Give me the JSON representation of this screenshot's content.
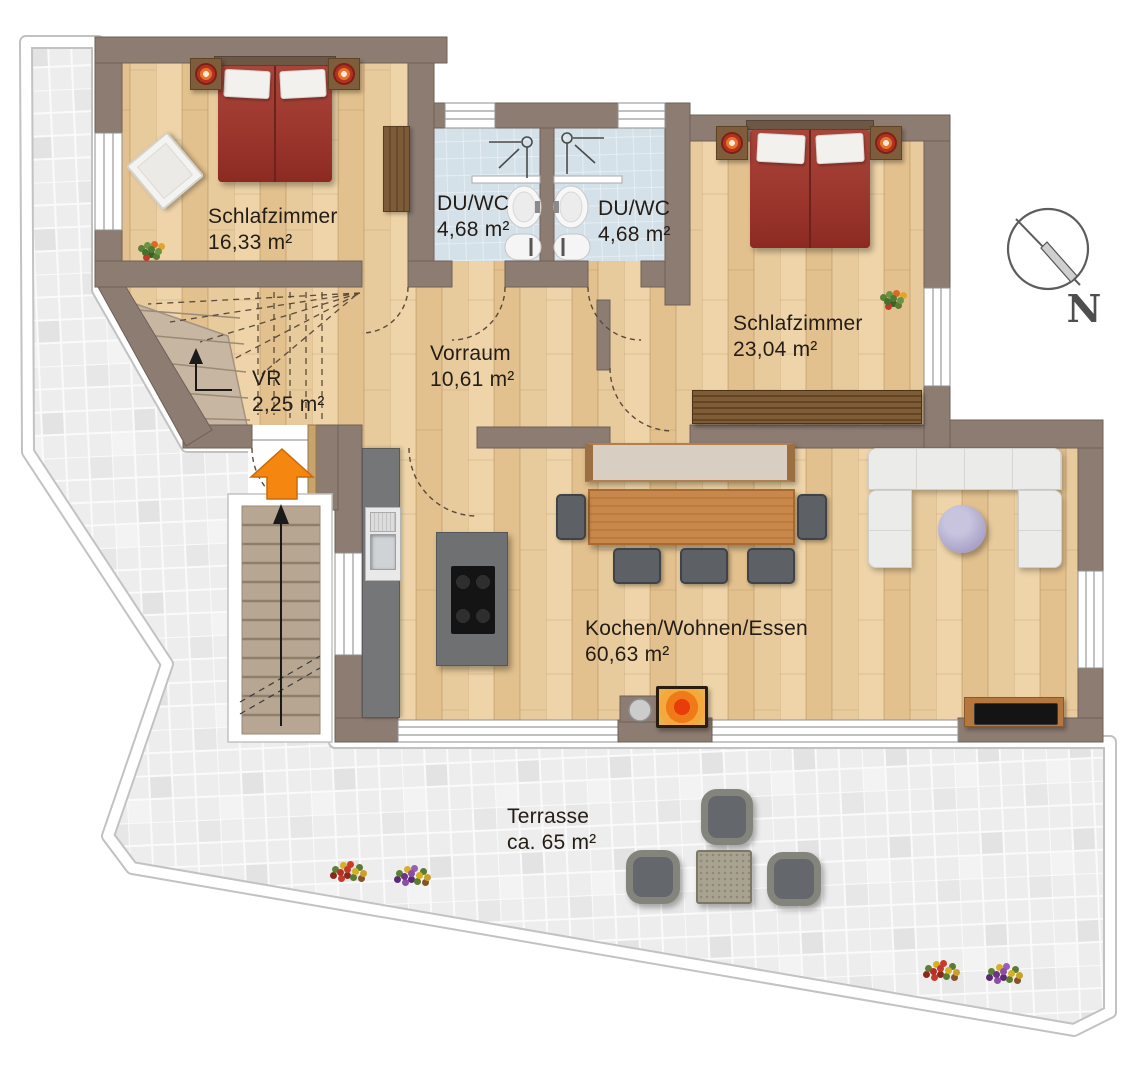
{
  "compass": {
    "label": "N",
    "icon": "north-compass-icon"
  },
  "rooms": [
    {
      "name": "Schlafzimmer",
      "area": "16,33 m²"
    },
    {
      "name": "DU/WC",
      "area": "4,68 m²"
    },
    {
      "name": "DU/WC",
      "area": "4,68 m²"
    },
    {
      "name": "Schlafzimmer",
      "area": "23,04 m²"
    },
    {
      "name": "Vorraum",
      "area": "10,61 m²"
    },
    {
      "name": "VR",
      "area": "2,25 m²"
    },
    {
      "name": "Kochen/Wohnen/Essen",
      "area": "60,63 m²"
    },
    {
      "name": "Terrasse",
      "area": "ca. 65 m²"
    }
  ],
  "icons": {
    "compass": "north-compass-icon",
    "entrance": "entrance-arrow-icon",
    "stairs_up": "stairs-up-arrow-icon",
    "shower": "shower-icon"
  },
  "colors": {
    "wall": "#8d7c72",
    "wood_floor": "#e9cda0",
    "bath_tile": "#d5e1e9",
    "terrace_tile": "#ededed",
    "bed_red": "#9c372e",
    "entrance_arrow": "#f5860f",
    "sofa": "#ebebe9",
    "dining_wood": "#c8864a",
    "stair_beige": "#c6b6a2"
  }
}
